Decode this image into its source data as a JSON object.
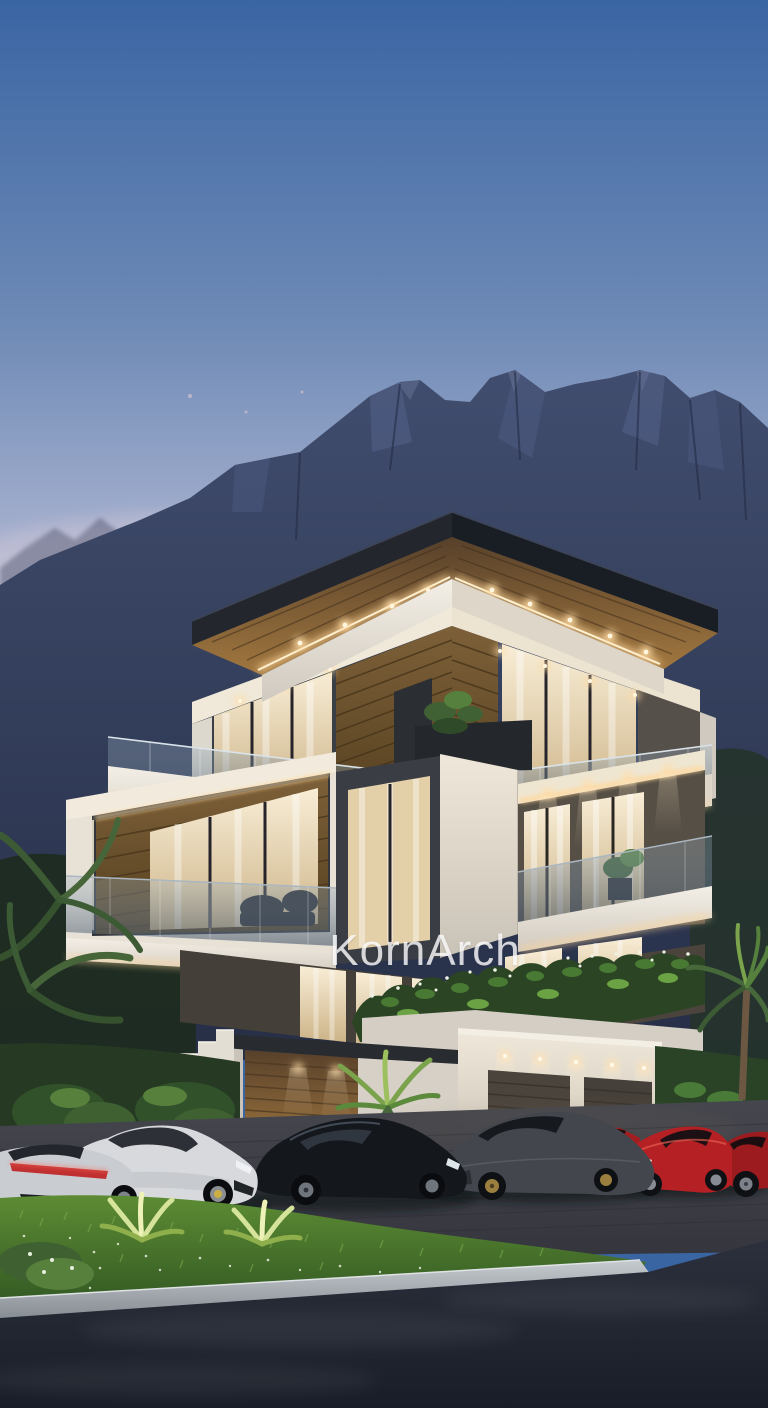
{
  "watermark": {
    "text": "KornArch"
  },
  "scene": {
    "description": "Dusk architectural render of a modern four-level villa with warm LED-lit soffits, wood paneling, glass balconies and roof planters; jagged mountain range behind; sports cars parked on a paver driveway; lawn with uplit plants, a curb and an asphalt road in the foreground.",
    "time_of_day": "dusk"
  },
  "colors": {
    "sky_top": "#3a65a3",
    "sky_mid": "#7490bd",
    "sky_horizon": "#d8cddd",
    "mountain_far": "#5a6585",
    "mountain_near": "#36415e",
    "roof_dark": "#20242b",
    "soffit_wood": "#8a6436",
    "led_glow": "#ffd79a",
    "wall_white": "#eae5dc",
    "window_warm": "#f3e3c2",
    "wood_panel": "#6a5133",
    "glass_railing": "#8fa2b3",
    "hedge_green": "#2c4527",
    "lawn_green": "#4a7a33",
    "curb_grey": "#b0b6ba",
    "road_dark": "#232834",
    "driveway_grey": "#3e3f46"
  },
  "cars": [
    {
      "name": "white-coupe-rear",
      "color": "#c9ccd1"
    },
    {
      "name": "white-supercar",
      "color": "#d7d9dc"
    },
    {
      "name": "black-supercar",
      "color": "#14171c"
    },
    {
      "name": "grey-supercar",
      "color": "#43464d"
    },
    {
      "name": "red-supercar-back",
      "color": "#a31d20"
    },
    {
      "name": "red-supercar",
      "color": "#b42024"
    },
    {
      "name": "red-supercar-edge",
      "color": "#9c1b1f"
    }
  ]
}
